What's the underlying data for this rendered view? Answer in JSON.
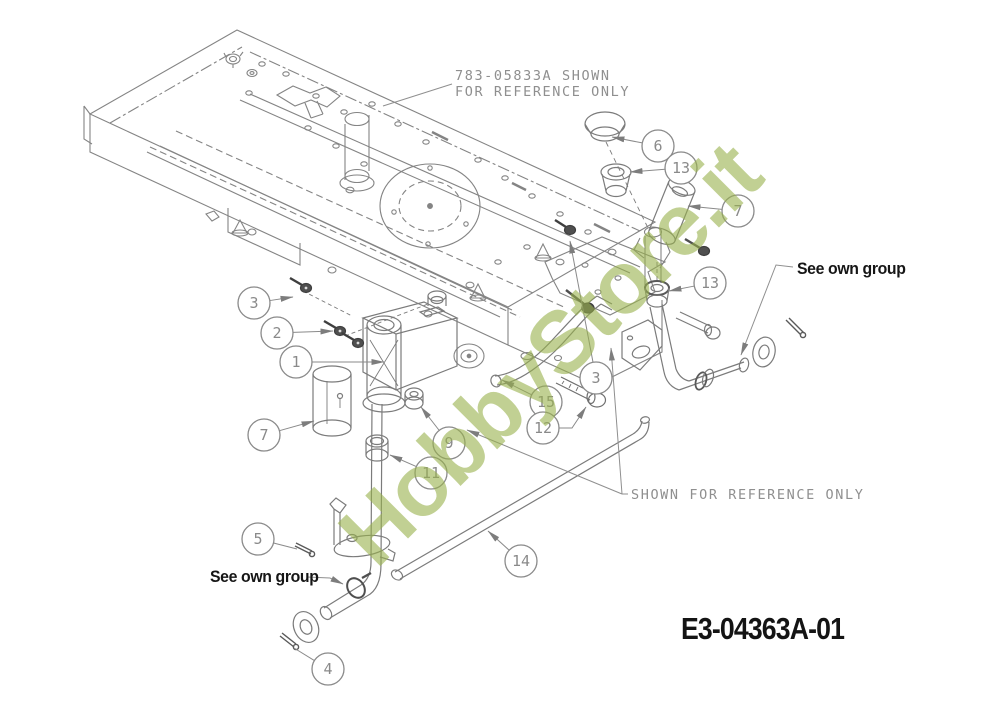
{
  "watermark": {
    "text": "HobbyStore.it",
    "color": "#97af4b"
  },
  "part_code": "E3-04363A-01",
  "annotations": {
    "top_note_line1": "783-05833A SHOWN",
    "top_note_line2": "FOR REFERENCE ONLY",
    "mid_note": "SHOWN FOR REFERENCE ONLY",
    "see_own_group_right": "See own group",
    "see_own_group_left": "See own group"
  },
  "colors": {
    "line": "#828282",
    "dark": "#4f4f4f",
    "cad_text": "#8f8f8f",
    "black_text": "#161616"
  },
  "callouts": [
    {
      "label": "6",
      "cx": 658,
      "cy": 146,
      "tx": 612,
      "ty": 137
    },
    {
      "label": "13",
      "cx": 681,
      "cy": 168,
      "tx": 630,
      "ty": 172
    },
    {
      "label": "7",
      "cx": 738,
      "cy": 211,
      "tx": 688,
      "ty": 206
    },
    {
      "label": "13",
      "cx": 710,
      "cy": 283,
      "tx": 669,
      "ty": 291
    },
    {
      "label": "3",
      "cx": 254,
      "cy": 303,
      "tx": 293,
      "ty": 297
    },
    {
      "label": "2",
      "cx": 277,
      "cy": 333,
      "tx": 333,
      "ty": 331
    },
    {
      "label": "1",
      "cx": 296,
      "cy": 362,
      "tx": 384,
      "ty": 362
    },
    {
      "label": "7",
      "cx": 264,
      "cy": 435,
      "tx": 314,
      "ty": 421
    },
    {
      "label": "3",
      "cx": 596,
      "cy": 378,
      "tx": 570,
      "ty": 241
    },
    {
      "label": "15",
      "cx": 546,
      "cy": 402,
      "tx": 502,
      "ty": 380
    },
    {
      "label": "12",
      "cx": 543,
      "cy": 428,
      "elbow": [
        572,
        428
      ],
      "tx": 586,
      "ty": 407
    },
    {
      "label": "9",
      "cx": 449,
      "cy": 443,
      "tx": 421,
      "ty": 407
    },
    {
      "label": "11",
      "cx": 431,
      "cy": 473,
      "tx": 390,
      "ty": 455
    },
    {
      "label": "5",
      "cx": 258,
      "cy": 539,
      "tx": 297,
      "ty": 549,
      "arrow": false
    },
    {
      "label": "14",
      "cx": 521,
      "cy": 561,
      "tx": 488,
      "ty": 531
    },
    {
      "label": "4",
      "cx": 328,
      "cy": 669,
      "tx": 294,
      "ty": 648,
      "arrow": false
    }
  ]
}
